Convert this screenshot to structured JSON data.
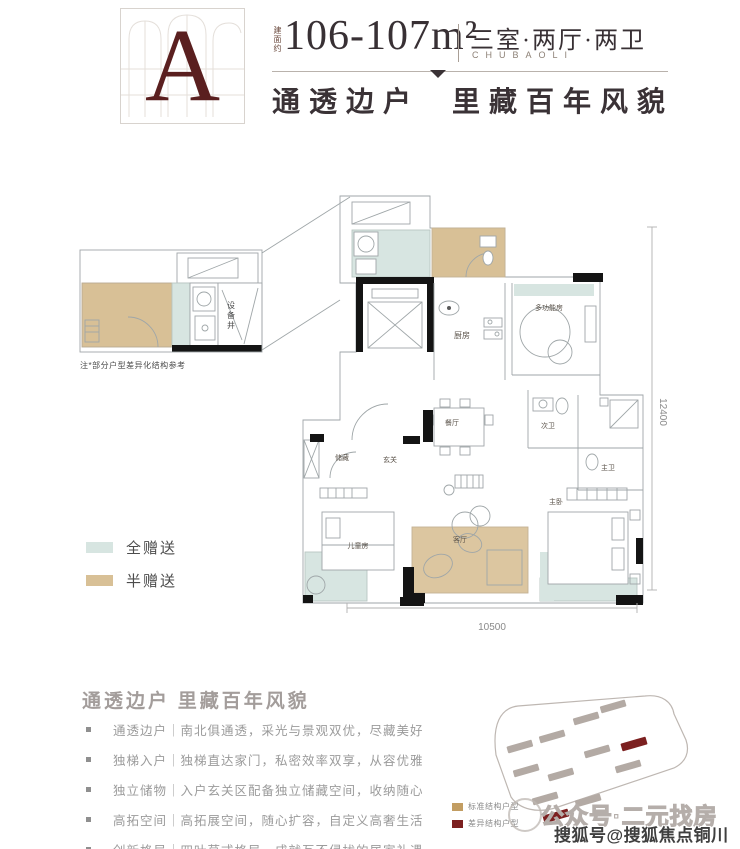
{
  "header": {
    "badge_letter": "A",
    "area_label": "建面约",
    "area_value": "106-107m²",
    "unit_type": "三室·两厅·两卫",
    "unit_type_sub": "CHUBAOLI",
    "slogan": "通透边户 里藏百年风貌"
  },
  "floorplan": {
    "note": "注*部分户型差异化结构参考",
    "rooms": {
      "equipment_shaft": "设备井",
      "kitchen": "厨房",
      "multifunction": "多功能房",
      "dining": "餐厅",
      "living": "客厅",
      "foyer": "玄关",
      "storage": "储藏",
      "kids_room": "儿童房",
      "master_bedroom": "主卧",
      "master_bath": "主卫",
      "second_bath": "次卫"
    },
    "dimensions": {
      "width": "10500",
      "height": "12400"
    },
    "legend": [
      {
        "label": "全赠送",
        "color": "#d7e5e1"
      },
      {
        "label": "半赠送",
        "color": "#d8c096"
      }
    ]
  },
  "features": {
    "heading": "通透边户 里藏百年风貌",
    "items": [
      "通透边户｜南北俱通透，采光与景观双优，尽藏美好",
      "独梯入户｜独梯直达家门，私密效率双享，从容优雅",
      "独立储物｜入户玄关区配备独立储藏空间，收纳随心",
      "高拓空间｜高拓展空间，随心扩容，自定义高奢生活",
      "创新格局｜四叶草式格局，成就互不侵扰的居家礼遇"
    ]
  },
  "siteplan": {
    "legend": [
      {
        "label": "标准结构户型",
        "color": "#c29d62"
      },
      {
        "label": "差异结构户型",
        "color": "#7c2020"
      }
    ]
  },
  "watermarks": {
    "outline_text": "公众号·二元找房",
    "solid_text": "搜狐号@搜狐焦点铜川站"
  },
  "colors": {
    "accent_dark_red": "#5a1f1f",
    "header_text": "#383034",
    "gift_full_teal": "#d7e5e1",
    "gift_half_tan": "#d8c096",
    "wall_black": "#141414",
    "plan_line": "#9fa6a8"
  }
}
